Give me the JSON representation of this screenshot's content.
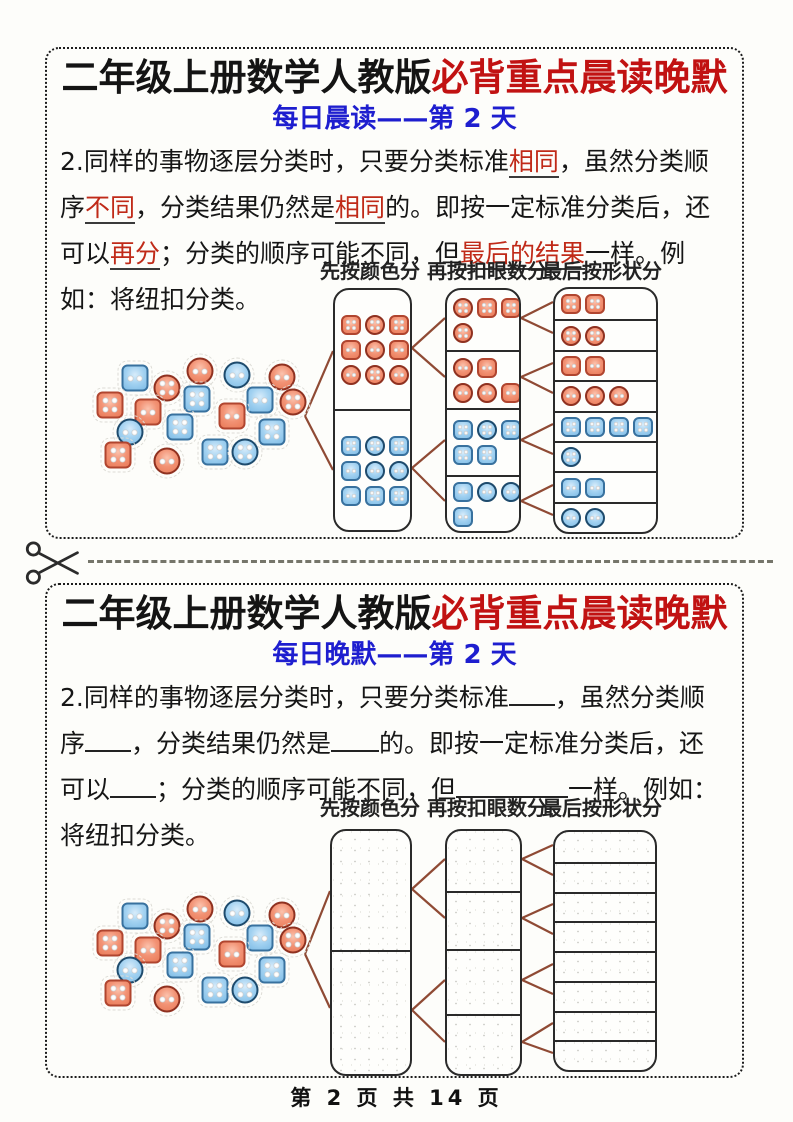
{
  "page": {
    "footer": "第 2 页 共 14 页"
  },
  "colors": {
    "title_red": "#c11212",
    "subtitle_blue": "#1e1ecf",
    "keyword_red": "#c02a18",
    "connector_brown": "#8f4a34",
    "red_button_fill": "#f08a6b",
    "red_button_border": "#b0452f",
    "blue_button_fill": "#93cbee",
    "blue_button_border": "#38719e",
    "cut_line_gray": "#75756a"
  },
  "scatter_buttons": [
    [
      "blue-sq-2",
      135,
      378
    ],
    [
      "red-ci-2",
      200,
      371
    ],
    [
      "blue-ci-2",
      237,
      375
    ],
    [
      "red-ci-2",
      282,
      377
    ],
    [
      "red-ci-4",
      167,
      388
    ],
    [
      "blue-sq-4",
      197,
      399
    ],
    [
      "blue-sq-2",
      260,
      400
    ],
    [
      "red-ci-4",
      293,
      402
    ],
    [
      "red-sq-4",
      110,
      405
    ],
    [
      "red-sq-2",
      148,
      412
    ],
    [
      "red-sq-2",
      232,
      416
    ],
    [
      "blue-ci-2",
      130,
      432
    ],
    [
      "blue-sq-4",
      180,
      427
    ],
    [
      "blue-sq-4",
      272,
      432
    ],
    [
      "red-sq-4",
      118,
      455
    ],
    [
      "red-ci-2",
      167,
      461
    ],
    [
      "blue-sq-4",
      215,
      452
    ],
    [
      "blue-ci-4",
      245,
      452
    ]
  ],
  "sections": [
    {
      "title_black": "二年级上册数学人教版",
      "title_red": "必背重点晨读晚默",
      "subtitle": "每日晨读——第 2 天",
      "paragraph": [
        {
          "type": "text",
          "text": "2.同样的事物逐层分类时，只要分类标准"
        },
        {
          "type": "hl",
          "text": "相同"
        },
        {
          "type": "text",
          "text": "，虽然分类顺序"
        },
        {
          "type": "hl",
          "text": "不同"
        },
        {
          "type": "text",
          "text": "，分类结果仍然是"
        },
        {
          "type": "hl",
          "text": "相同"
        },
        {
          "type": "text",
          "text": "的。即按一定标准分类后，还可以"
        },
        {
          "type": "hl",
          "text": "再分"
        },
        {
          "type": "text",
          "text": "；分类的顺序可能不同，但"
        },
        {
          "type": "hl",
          "text": "最后的结果"
        },
        {
          "type": "text",
          "text": "一样。例如：将纽扣分类。"
        }
      ],
      "diagram": {
        "labels": [
          "先按颜色分",
          "再按扣眼数分",
          "最后按形状分"
        ],
        "filled": true,
        "col1_cells": [
          {
            "rows": [
              [
                "red-sq-4",
                "red-ci-4",
                "red-sq-4"
              ],
              [
                "red-sq-2",
                "red-ci-2",
                "red-sq-2"
              ],
              [
                "red-ci-2",
                "red-ci-4",
                "red-ci-2"
              ]
            ]
          },
          {
            "rows": [
              [
                "blue-sq-4",
                "blue-ci-4",
                "blue-sq-4"
              ],
              [
                "blue-sq-2",
                "blue-ci-2",
                "blue-ci-2"
              ],
              [
                "blue-sq-2",
                "blue-sq-4",
                "blue-sq-4"
              ]
            ]
          }
        ],
        "col2_cells": [
          {
            "rows": [
              [
                "red-ci-4",
                "red-sq-4",
                "red-sq-4"
              ],
              [
                "red-ci-4"
              ]
            ]
          },
          {
            "rows": [
              [
                "red-ci-2",
                "red-sq-2"
              ],
              [
                "red-ci-2",
                "red-ci-2",
                "red-sq-2"
              ]
            ]
          },
          {
            "rows": [
              [
                "blue-sq-4",
                "blue-ci-4",
                "blue-sq-4"
              ],
              [
                "blue-sq-4",
                "blue-sq-4"
              ]
            ]
          },
          {
            "rows": [
              [
                "blue-sq-2",
                "blue-ci-2",
                "blue-ci-2"
              ],
              [
                "blue-sq-2"
              ]
            ]
          }
        ],
        "col3_cells": [
          {
            "rows": [
              [
                "red-sq-4",
                "red-sq-4"
              ]
            ]
          },
          {
            "rows": [
              [
                "red-ci-4",
                "red-ci-4"
              ]
            ]
          },
          {
            "rows": [
              [
                "red-sq-2",
                "red-sq-2"
              ]
            ]
          },
          {
            "rows": [
              [
                "red-ci-2",
                "red-ci-2",
                "red-ci-2"
              ]
            ]
          },
          {
            "rows": [
              [
                "blue-sq-4",
                "blue-sq-4",
                "blue-sq-4",
                "blue-sq-4"
              ]
            ]
          },
          {
            "rows": [
              [
                "blue-ci-4"
              ]
            ]
          },
          {
            "rows": [
              [
                "blue-sq-2",
                "blue-sq-2"
              ]
            ]
          },
          {
            "rows": [
              [
                "blue-ci-2",
                "blue-ci-2"
              ]
            ]
          }
        ]
      }
    },
    {
      "title_black": "二年级上册数学人教版",
      "title_red": "必背重点晨读晚默",
      "subtitle": "每日晚默——第 2 天",
      "paragraph": [
        {
          "type": "text",
          "text": "2.同样的事物逐层分类时，只要分类标准"
        },
        {
          "type": "blank",
          "width": 46
        },
        {
          "type": "text",
          "text": "，虽然分类顺序"
        },
        {
          "type": "blank",
          "width": 46
        },
        {
          "type": "text",
          "text": "，分类结果仍然是"
        },
        {
          "type": "blank",
          "width": 48
        },
        {
          "type": "text",
          "text": "的。即按一定标准分类后，还可以"
        },
        {
          "type": "blank",
          "width": 46
        },
        {
          "type": "text",
          "text": "；分类的顺序可能不同，但"
        },
        {
          "type": "blank",
          "width": 112
        },
        {
          "type": "text",
          "text": "一样。例如：将纽扣分类。"
        }
      ],
      "diagram": {
        "labels": [
          "先按颜色分",
          "再按扣眼数分",
          "最后按形状分"
        ],
        "filled": false,
        "col1_cells": [
          {
            "rows": []
          },
          {
            "rows": []
          }
        ],
        "col2_cells": [
          {
            "rows": []
          },
          {
            "rows": []
          },
          {
            "rows": []
          },
          {
            "rows": []
          }
        ],
        "col3_cells": [
          {
            "rows": []
          },
          {
            "rows": []
          },
          {
            "rows": []
          },
          {
            "rows": []
          },
          {
            "rows": []
          },
          {
            "rows": []
          },
          {
            "rows": []
          },
          {
            "rows": []
          }
        ]
      }
    }
  ]
}
